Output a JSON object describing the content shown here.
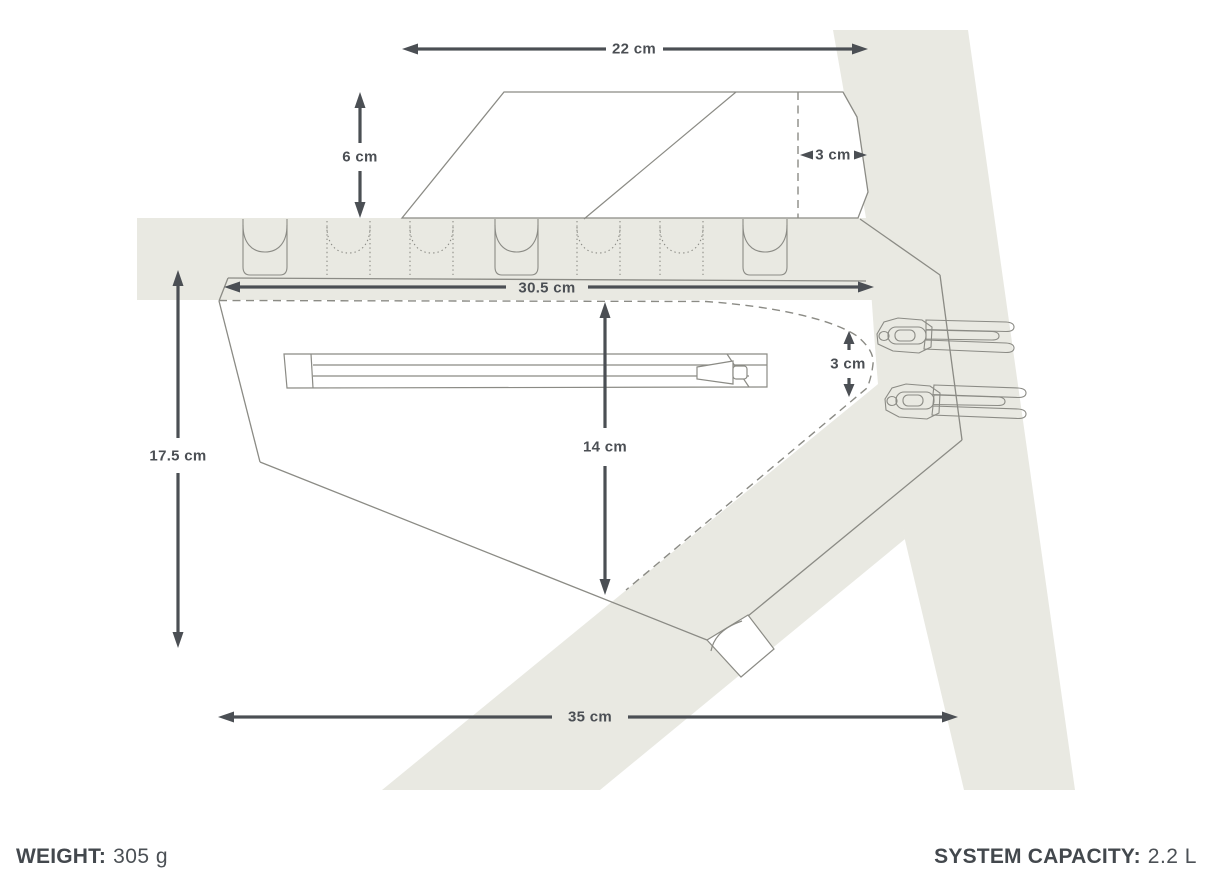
{
  "diagram": {
    "dimensions": {
      "top_width": "22 cm",
      "top_height": "6 cm",
      "top_depth": "3 cm",
      "pack_top_length": "30.5 cm",
      "rear_depth": "3 cm",
      "mid_height": "14 cm",
      "front_height": "17.5 cm",
      "bottom_length": "35 cm"
    }
  },
  "footer": {
    "weight_label": "WEIGHT:",
    "weight_value": "305 g",
    "capacity_label": "SYSTEM CAPACITY:",
    "capacity_value": "2.2 L"
  },
  "colors": {
    "frame_fill": "#e9e9e2",
    "outline": "#8b8b85",
    "dimension": "#4b4f54",
    "footer_text": "#43484d"
  }
}
